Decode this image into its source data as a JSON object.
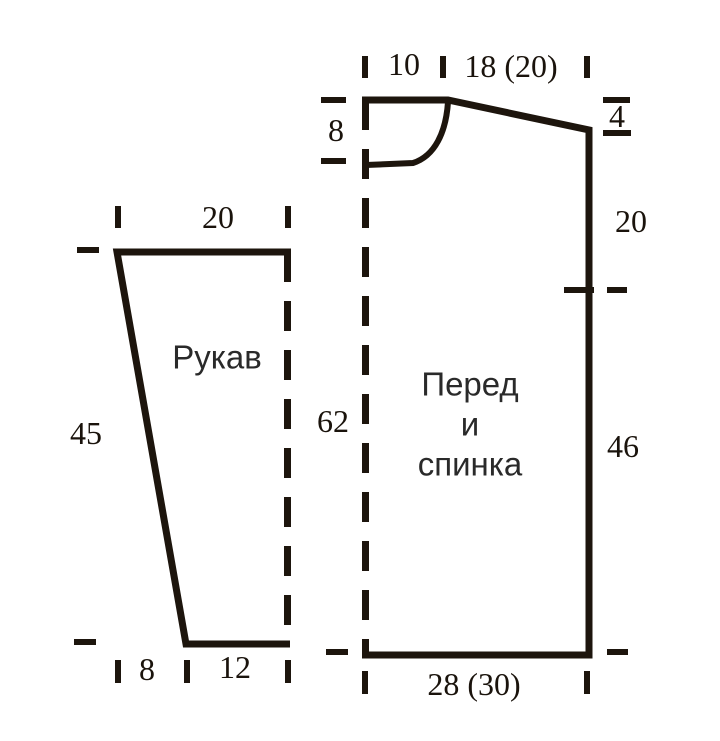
{
  "diagram": {
    "type": "knitting-pattern-schematic",
    "colors": {
      "line": "#1d150d",
      "number_text": "#1a130c",
      "label_text": "#2a2a2a",
      "background": "#ffffff"
    },
    "sleeve": {
      "label": "Рукав",
      "top_width": "20",
      "side_height": "45",
      "bottom_offset": "8",
      "bottom_width": "12"
    },
    "body": {
      "label_line1": "Перед",
      "label_line2": "и",
      "label_line3": "спинка",
      "neck_half_width": "10",
      "shoulder_width": "18 (20)",
      "neck_depth": "8",
      "shoulder_drop": "4",
      "yoke_height": "20",
      "center_height": "62",
      "side_height": "46",
      "bottom_width": "28 (30)"
    }
  }
}
